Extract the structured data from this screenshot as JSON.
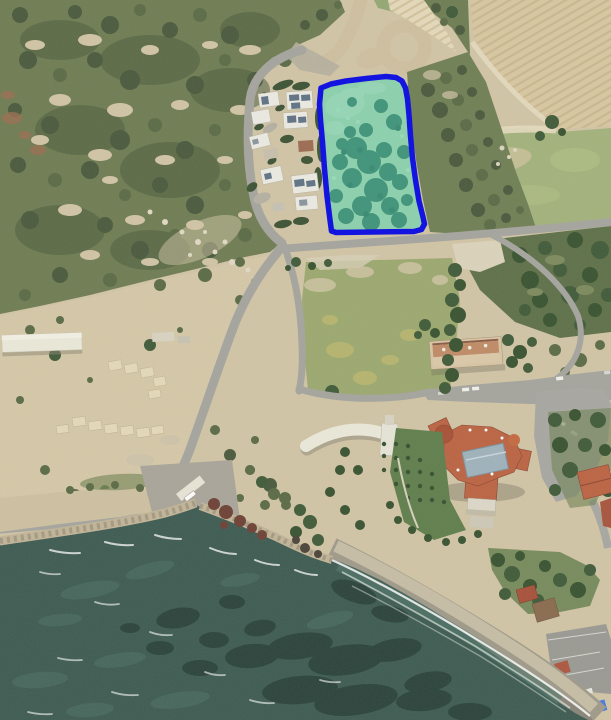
{
  "map": {
    "kind": "satellite-aerial-photo",
    "scene": "coastal land area with villas, fields, scrubland, a beachfront hotel and a sea bay; one vacant green parcel is highlighted with a blue boundary overlay",
    "annotation": {
      "parcel_outline_points": "321,88 331,84 346,81 366,78.5 386,76.5 396,77.5 402,81 405.5,88 407.5,99 409,115 410.5,136 412.5,158 415.5,180 419,201 423,217 424.5,224 421.5,229.5 414,231.5 336,232.5 331.5,231 330,220 327,196 324.5,169 322.5,142 320.5,120 319.5,104",
      "outline_color": "#1414e0",
      "outline_width": 5.5,
      "fill_color": "#52d8bc",
      "fill_opacity": 0.48
    },
    "palette": {
      "soil": "#d2c5a6",
      "soil_light": "#e6dabb",
      "scrub": "#6e7c52",
      "scrub_dark": "#49593c",
      "veg_olive": "#5a6a45",
      "tree": "#3f5a38",
      "tree_dark": "#37522f",
      "field": "#d9c8a1",
      "furrow": "#c0ab83",
      "grass": "#a3b37c",
      "grass_light": "#b3c286",
      "road": "#a5a59f",
      "dirt_road": "#cfc0a0",
      "pavement": "#aaa59a",
      "building_white": "#edece4",
      "solar_panel": "#5f7285",
      "roof_red": "#bc6342",
      "roof_brown": "#8a6a4e",
      "atrium_grey": "#9fb2bc",
      "lawn": "#5f7e4c",
      "sea": "#3c5a51",
      "sea_dark": "#263e37",
      "sea_light": "#4e7266",
      "shallow": "#547a6e",
      "foam": "#ffffff",
      "beach": "#a09a8a",
      "sand_dry": "#cbc2a8",
      "sand_wet": "#827e72",
      "rock_red": "#6e4034",
      "riprap": "#c2b598",
      "canopy_blue": "#3a6fd8",
      "highlight_fill": "#52d8bc",
      "highlight_outline": "#1414e0"
    }
  }
}
